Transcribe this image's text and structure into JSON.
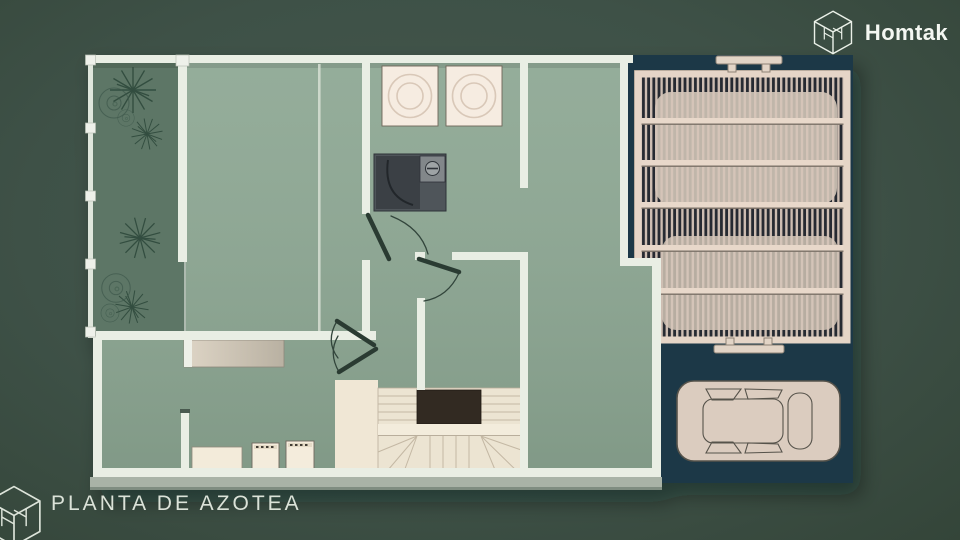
{
  "brand": {
    "name": "Homtak",
    "icon": "homtak-cube-icon"
  },
  "footer": {
    "title": "PLANTA DE AZOTEA",
    "icon": "homtak-cube-icon"
  },
  "palette": {
    "background": "#3e5147",
    "roof_floor_sage": "#8ea894",
    "garden_green": "#5d7666",
    "wall_cream": "#e9eee4",
    "furniture_cream": "#f2e9d8",
    "driveway_teal": "#1a3947",
    "pergola_slat": "#d6c5b9",
    "pergola_beam": "#e8d8ca",
    "stair_void_brown": "#332a24",
    "door_dark_green": "#2a3a33",
    "shower_gray": "#50555a",
    "car_body": "#dbccbf",
    "text_light": "#f4f7f2",
    "footer_text": "#dbe2d8"
  },
  "icons": [
    "homtak-cube-icon",
    "plant-starburst-icon",
    "plant-bush-icon",
    "skylight-icon",
    "shower-icon",
    "door-swing-icon",
    "stairs-icon",
    "bed-icon",
    "car-icon",
    "gate-handle-icon"
  ]
}
